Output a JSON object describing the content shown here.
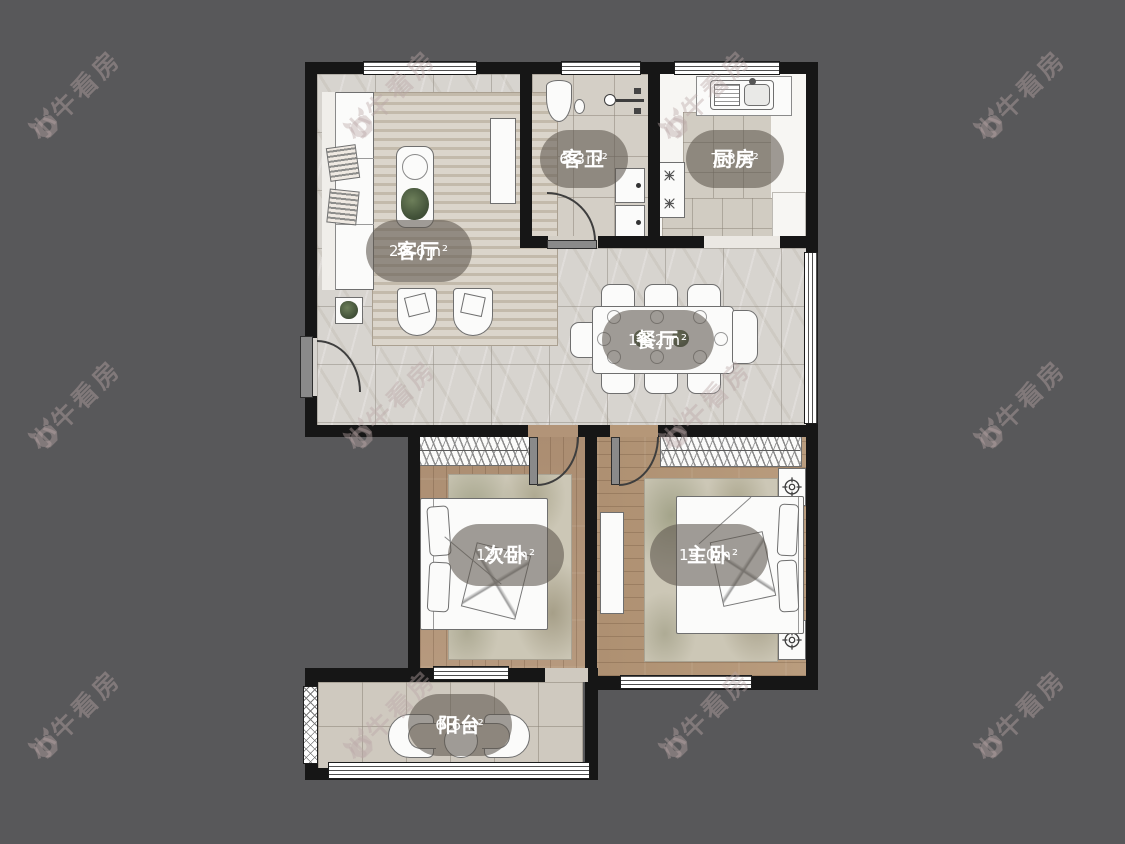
{
  "watermark": {
    "brand": "小牛看房"
  },
  "floorplan": {
    "rooms": [
      {
        "name": "客厅",
        "area": "20.6m²"
      },
      {
        "name": "客卫",
        "area": "6.3m²"
      },
      {
        "name": "厨房",
        "area": "7.3m²"
      },
      {
        "name": "餐厅",
        "area": "14.2m²"
      },
      {
        "name": "次卧",
        "area": "12.4m²"
      },
      {
        "name": "主卧",
        "area": "15.0m²"
      },
      {
        "name": "阳台",
        "area": "6.6m²"
      }
    ]
  },
  "colors": {
    "background": "#58585a",
    "wall": "#161616",
    "marble_tile": "#d7d4cf",
    "wood_floor": "#b29478",
    "label_bubble": "rgba(93,86,78,0.58)",
    "watermark": "rgba(186,166,166,0.42)"
  }
}
